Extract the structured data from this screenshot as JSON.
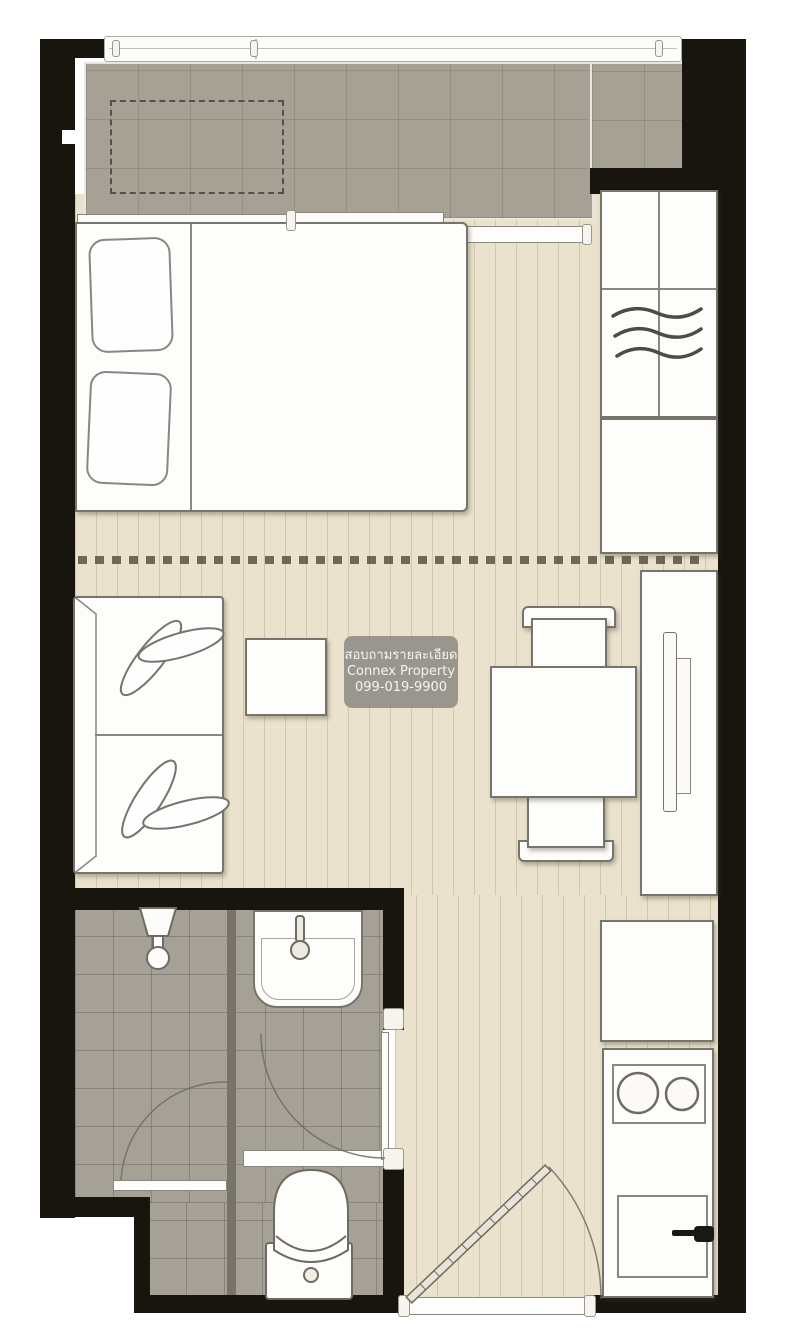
{
  "watermark": {
    "line1": "สอบถามรายละเอียด",
    "line2": "Connex Property",
    "line3": "099-019-9900"
  },
  "palette": {
    "wall": "#18150f",
    "balcony_floor": "#a7a195",
    "bath_floor": "#a6a197",
    "floor": "#eae2cc",
    "outline": "#77746c",
    "dash": "#59523f",
    "watermark_bg": "rgba(148,144,136,0.93)",
    "watermark_text": "#f6f4ef",
    "plank_line": "rgba(139,128,100,0.28)",
    "tile_line": "rgba(85,80,70,0.22)",
    "tile_line2": "rgba(70,65,58,0.3)"
  },
  "fixtures": [
    "balcony-railing",
    "ac-condenser-dashed",
    "sliding-glass-door",
    "double-bed",
    "wardrobe-hangers",
    "storage-cabinet",
    "tv-console",
    "television",
    "sofa",
    "side-table",
    "dining-table",
    "dining-chairs",
    "refrigerator",
    "stove-burners",
    "kitchen-sink",
    "bathroom-sink",
    "shower-head",
    "toilet",
    "entrance-door-swing",
    "bathroom-door-swing",
    "shower-door-swing"
  ]
}
